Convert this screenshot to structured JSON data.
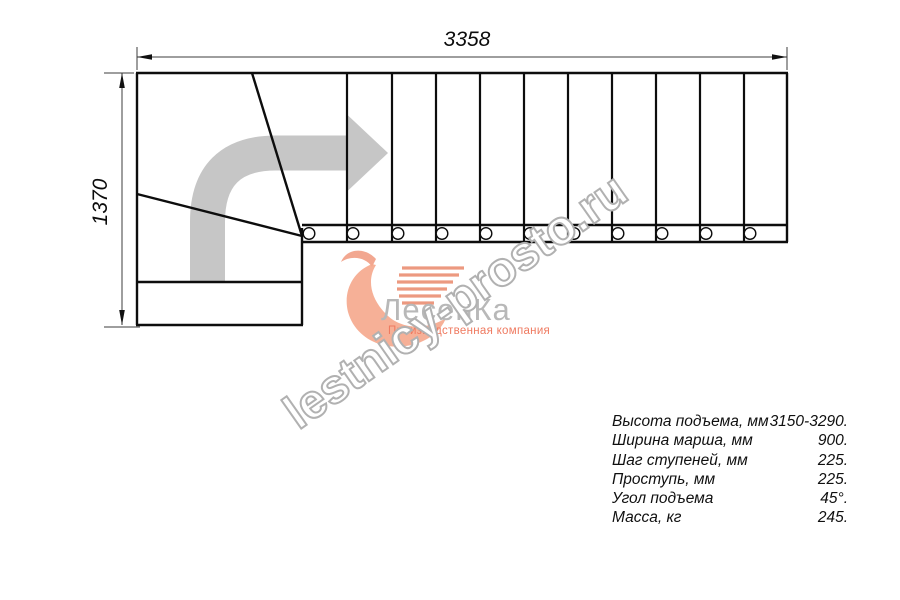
{
  "dimensions": {
    "width_label": "3358",
    "height_label": "1370"
  },
  "watermark": {
    "text": "lestnicy-prosto.ru"
  },
  "logo": {
    "name": "ЛесенКа",
    "tagline": "Производственная компания"
  },
  "specs": {
    "rows": [
      {
        "label": "Высота подъема, мм",
        "value": "3150-3290."
      },
      {
        "label": "Ширина марша, мм",
        "value": "900."
      },
      {
        "label": "Шаг ступеней, мм",
        "value": "225."
      },
      {
        "label": "Проступь, мм",
        "value": "225."
      },
      {
        "label": "Угол подъема",
        "value": "45°."
      },
      {
        "label": "Масса, кг",
        "value": "245."
      }
    ]
  },
  "colors": {
    "drawing_line": "#0d0d0d",
    "dimension_line": "#3c3c3c",
    "direction_arrow": "#c6c6c6",
    "watermark_outline": "#b1b1b1",
    "logo_text": "#b8b8b8",
    "logo_accent": "#ef7a60",
    "logo_swoosh": "#f5a78c"
  }
}
